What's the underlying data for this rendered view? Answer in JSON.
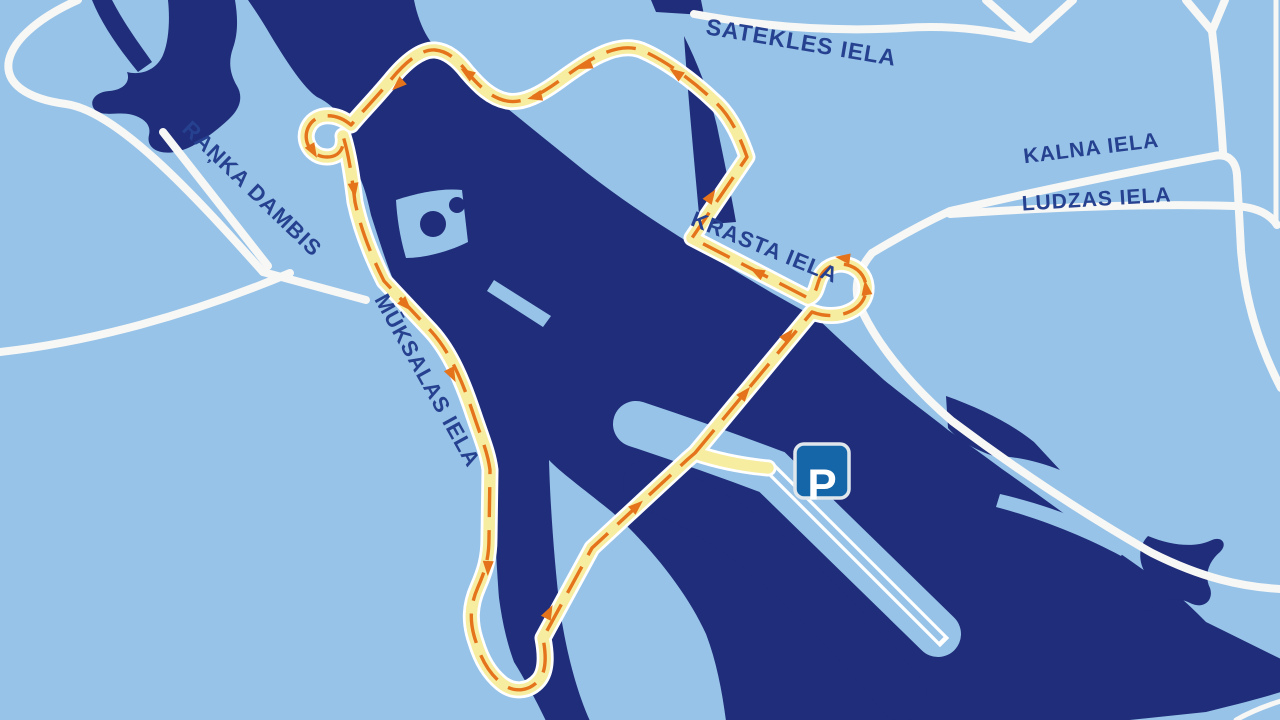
{
  "map": {
    "street_labels": [
      {
        "id": "satekles",
        "text": "SATEKLES IELA"
      },
      {
        "id": "kalna",
        "text": "KALNA IELA"
      },
      {
        "id": "ludzas",
        "text": "LUDZAS IELA"
      },
      {
        "id": "krasta",
        "text": "KRASTA IELA"
      },
      {
        "id": "ranka",
        "text": "RAŅKA DAMBIS"
      },
      {
        "id": "muksalas",
        "text": "MŪKSALAS IELA"
      }
    ],
    "parking_sign": {
      "label": "P"
    },
    "colors": {
      "background_land": "#97c3e8",
      "water_navy": "#1f2d7a",
      "road_white": "#f7f7f5",
      "route_yellow": "#f7eda1",
      "route_casing": "#ffffff",
      "route_core_orange": "#e4731b",
      "street_label_navy": "#26418f",
      "parking_sign_blue": "#1466a9",
      "parking_sign_border": "#dfe6ec"
    }
  }
}
